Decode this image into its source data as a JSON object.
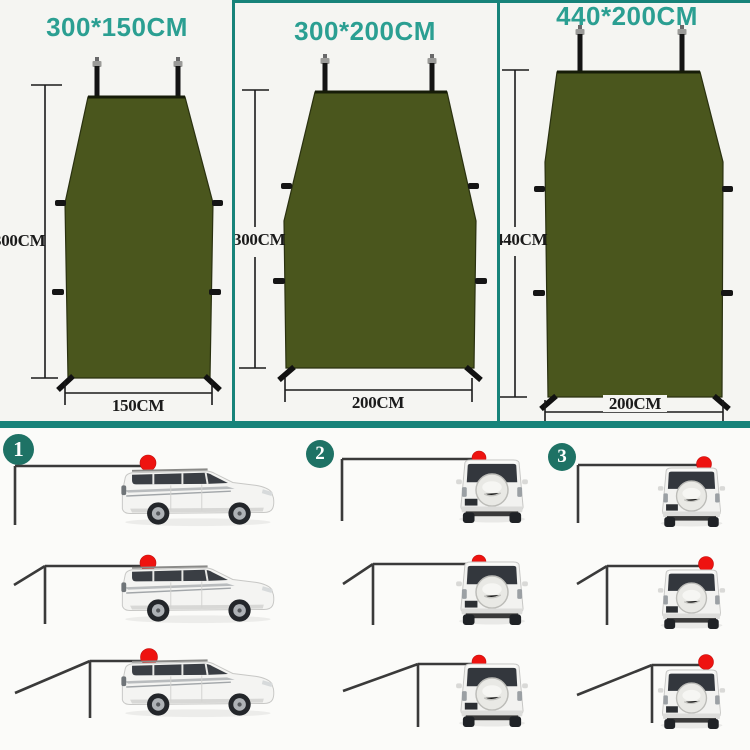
{
  "panels": [
    {
      "title": "300*150CM",
      "height_label": "300CM",
      "width_label": "150CM"
    },
    {
      "title": "300*200CM",
      "height_label": "300CM",
      "width_label": "200CM"
    },
    {
      "title": "440*200CM",
      "height_label": "440CM",
      "width_label": "200CM"
    }
  ],
  "setups": [
    {
      "number": "1",
      "car_view": "side-view-suv",
      "configurations": 3
    },
    {
      "number": "2",
      "car_view": "rear-view-suv",
      "configurations": 3
    },
    {
      "number": "3",
      "car_view": "rear-view-suv",
      "configurations": 3
    }
  ],
  "colors": {
    "teal_border": "#17837a",
    "title_text": "#2b9f92",
    "badge_fill": "#1e7265",
    "tarp_green": "#4a561d",
    "red_marker": "#ee1310",
    "awning_line": "#3a3a3a",
    "dimension_text": "#1b1b1b"
  }
}
